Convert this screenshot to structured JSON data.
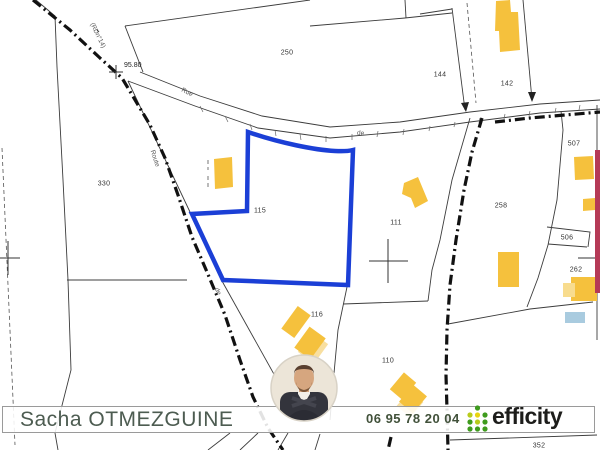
{
  "map": {
    "parcels": {
      "p250": "250",
      "p144": "144",
      "p142": "142",
      "p330": "330",
      "p115": "115",
      "p111": "111",
      "p258": "258",
      "p507": "507",
      "p506": "506",
      "p262": "262",
      "p116": "116",
      "p110": "110",
      "p352": "352"
    },
    "roads": {
      "rue": "Rue",
      "de1": "de",
      "route": "Route",
      "rd14": "(RDn°14)",
      "de2": "de"
    },
    "elevation": "95.80",
    "colors": {
      "highlight_parcel": "#1b3fd6",
      "building": "#f5c13d",
      "building_shadow": "#f8dfa0",
      "pool": "#a9cbdf",
      "map_edge_strip": "#b53a56",
      "boundary_line": "#3c3c3c",
      "limit_dash": "#111111"
    }
  },
  "footer": {
    "agent_name": "Sacha OTMEZGUINE",
    "phone": "06 95 78 20 04",
    "brand": "efficity",
    "brand_green": "#3f9b1e",
    "brand_yellow_green": "#b8cc1c",
    "brand_yellow": "#e8d411",
    "name_color": "#4d5c51"
  }
}
